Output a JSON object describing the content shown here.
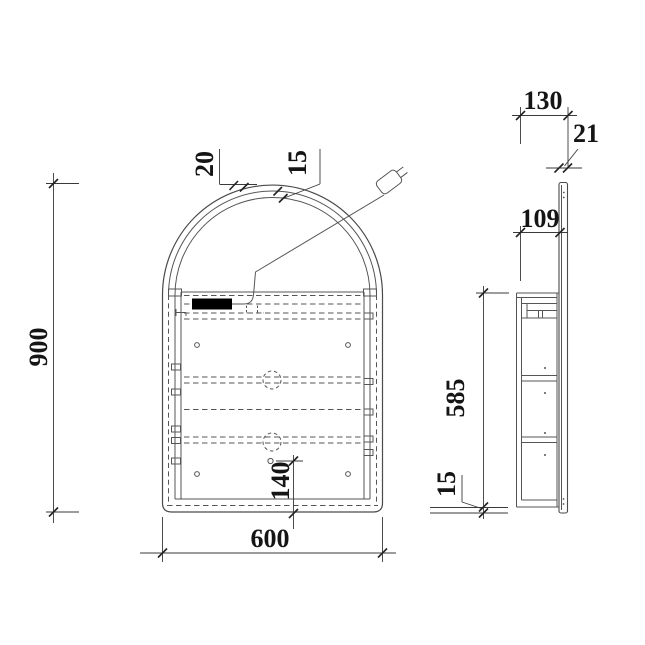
{
  "drawing_type": "arched-mirror-cabinet-technical-drawing",
  "front_view": {
    "overall_height": "900",
    "overall_width": "600",
    "frame_thickness": "20",
    "mirror_recess": "15",
    "bottom_hole_offset": "140"
  },
  "side_view": {
    "overall_depth": "130",
    "mirror_thickness": "21",
    "cabinet_depth": "109",
    "cabinet_height": "585",
    "bottom_lip": "15"
  },
  "icons": {
    "power_plug": "power-plug-icon",
    "led_driver": "led-driver-block"
  },
  "colors": {
    "background": "#ffffff",
    "outline": "#4f4f4f",
    "line": "#5a5a5a",
    "dimension": "#3a3a3a",
    "text": "#151515",
    "driver_fill": "#000000"
  }
}
